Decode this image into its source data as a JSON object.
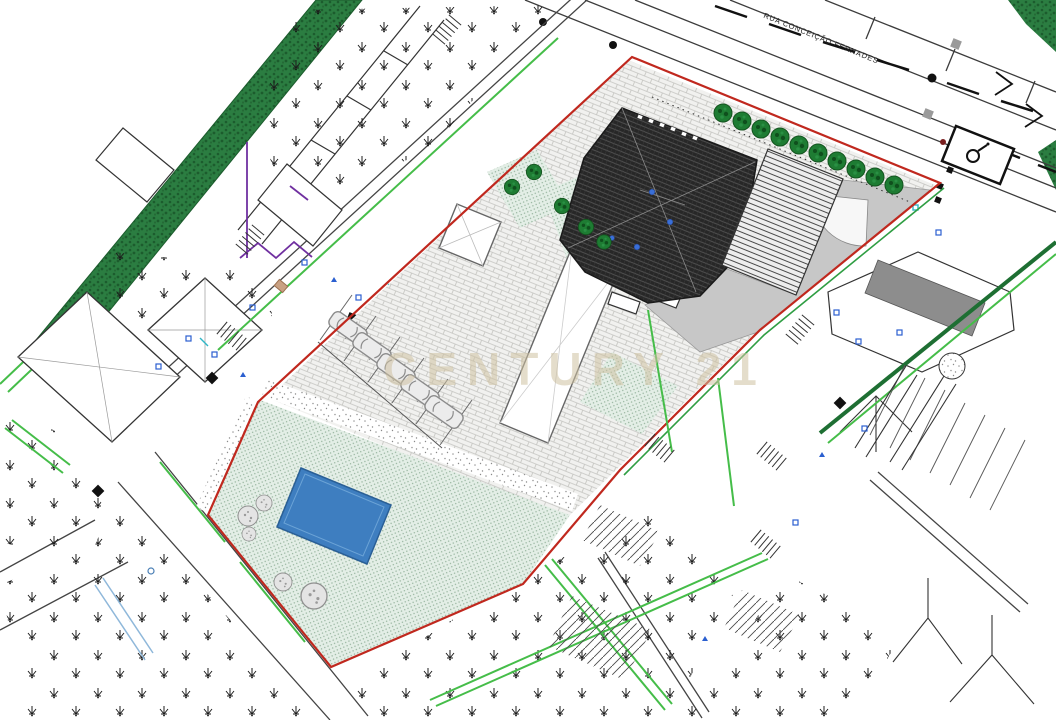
{
  "document": {
    "type": "architectural-site-plan",
    "street_label": "RUA CONCEIÇÃO FERNADES",
    "watermark_text": "CENTURY 21"
  },
  "colors": {
    "boundary_red": "#c0281e",
    "companion_green": "#2f9e43",
    "bright_green": "#45bd49",
    "hedge_green": "#2b7d41",
    "pool_fill": "#3e7ec0",
    "pool_edge": "#2a5f96",
    "lawn_green": "#e3eee6",
    "terrace_gray": "#c7c7c7",
    "roof_solid_gray": "#8d8d8d",
    "purple": "#7030a0",
    "drain_blue": "#8fb8da",
    "utility_blue": "#2b5fd0",
    "watermark_tan": "#cfc2a2"
  },
  "features": {
    "street_trees": 10,
    "parked_cars": 5,
    "pools": 1,
    "garden_bushes": 5
  }
}
